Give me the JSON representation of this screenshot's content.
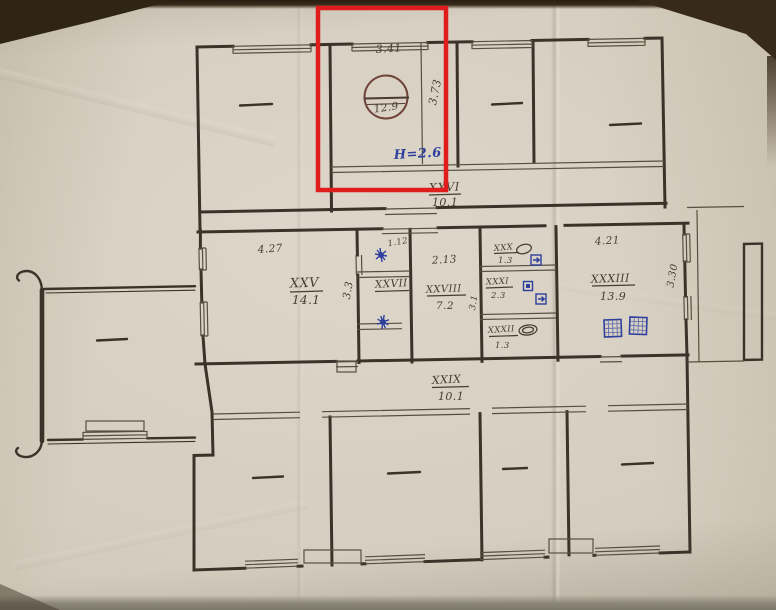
{
  "plan": {
    "highlight_note": "H=2.6",
    "rooms": {
      "xxv": {
        "label": "XXV",
        "area": "14.1"
      },
      "xxvi": {
        "label": "XXVI",
        "area": "10.1"
      },
      "xxvii": {
        "label": "XXVII"
      },
      "xxviii": {
        "label": "XXVIII",
        "area": "7.2"
      },
      "xxix": {
        "label": "XXIX",
        "area": "10.1"
      },
      "xxx": {
        "label": "XXX",
        "area": "1.3"
      },
      "xxxi": {
        "label": "XXXI",
        "area": "2.3"
      },
      "xxxii": {
        "label": "XXXII",
        "area": "1.3"
      },
      "xxxiii": {
        "label": "XXXIII",
        "area": "13.9"
      }
    },
    "dimensions": {
      "highlighted_room_width": "3.41",
      "highlighted_room_depth": "3.73",
      "highlighted_room_area_circled": "12.9",
      "room_xxv_width": "4.27",
      "room_xxv_depth": "3.3",
      "niche_width": "1.12",
      "room_xxviii_width": "2.13",
      "small_rooms_depth": "3.1",
      "room_xxxiii_width": "4.21",
      "room_xxxiii_depth": "3.30"
    }
  },
  "colors": {
    "highlight": "#e01c1c",
    "ink_blue": "#2e3f9e",
    "pencil": "#473e30",
    "paper": "#d8d1c4"
  }
}
